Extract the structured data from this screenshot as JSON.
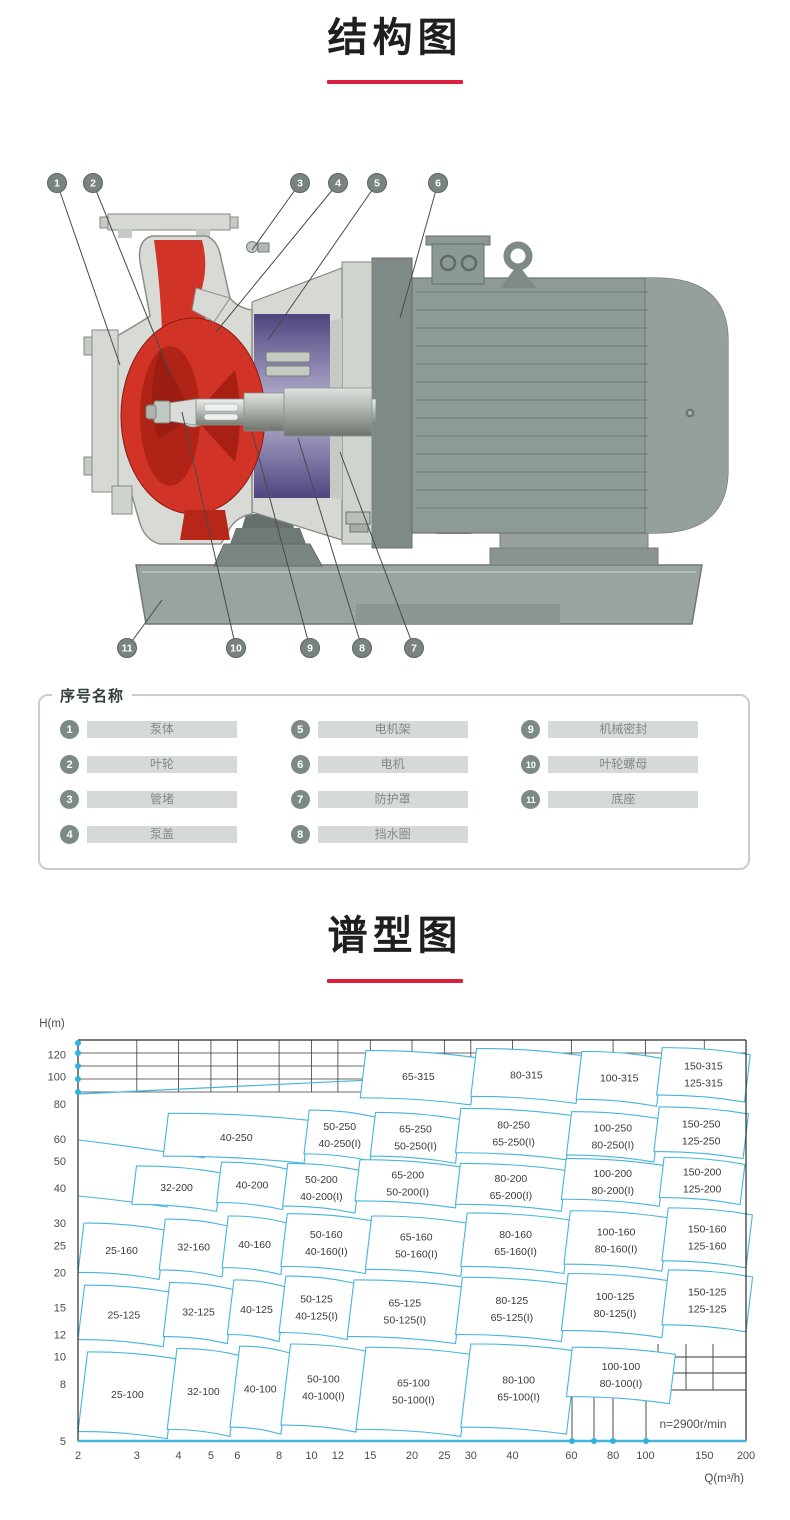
{
  "titles": {
    "structure": "结构图",
    "chart": "谱型图"
  },
  "structure": {
    "callouts": [
      "1",
      "2",
      "3",
      "4",
      "5",
      "6",
      "7",
      "8",
      "9",
      "10",
      "11"
    ]
  },
  "legend": {
    "title": "序号名称",
    "items": [
      {
        "num": "1",
        "name": "泵体"
      },
      {
        "num": "2",
        "name": "叶轮"
      },
      {
        "num": "3",
        "name": "管堵"
      },
      {
        "num": "4",
        "name": "泵盖"
      },
      {
        "num": "5",
        "name": "电机架"
      },
      {
        "num": "6",
        "name": "电机"
      },
      {
        "num": "7",
        "name": "防护罩"
      },
      {
        "num": "8",
        "name": "挡水圈"
      },
      {
        "num": "9",
        "name": "机械密封"
      },
      {
        "num": "10",
        "name": "叶轮螺母"
      },
      {
        "num": "11",
        "name": "底座"
      }
    ]
  },
  "chart_data": {
    "type": "region_map",
    "title": "谱型图",
    "xlabel": "Q(m³/h)",
    "ylabel": "H(m)",
    "x_scale": "log",
    "y_scale": "log",
    "xlim": [
      2,
      200
    ],
    "ylim": [
      5,
      137
    ],
    "x_ticks": [
      2,
      3,
      4,
      5,
      6,
      8,
      10,
      12,
      15,
      20,
      25,
      30,
      40,
      60,
      80,
      100,
      150,
      200
    ],
    "y_ticks": [
      5,
      8,
      10,
      12,
      15,
      20,
      25,
      30,
      40,
      50,
      60,
      80,
      100,
      120
    ],
    "annotation": "n=2900r/min",
    "line_color": "#45b5dc",
    "regions": [
      {
        "labels": [
          "65-315"
        ],
        "q": [
          14,
          30
        ],
        "h": [
          84,
          124
        ]
      },
      {
        "labels": [
          "80-315"
        ],
        "q": [
          30,
          62
        ],
        "h": [
          85,
          126
        ]
      },
      {
        "labels": [
          "100-315"
        ],
        "q": [
          62,
          108
        ],
        "h": [
          83,
          123
        ]
      },
      {
        "labels": [
          "150-315",
          "125-315"
        ],
        "q": [
          108,
          198
        ],
        "h": [
          86,
          127
        ]
      },
      {
        "labels": [
          "40-250"
        ],
        "q": [
          3.6,
          9.5
        ],
        "h": [
          52,
          74
        ]
      },
      {
        "labels": [
          "50-250",
          "40-250(I)"
        ],
        "q": [
          9.5,
          15
        ],
        "h": [
          53,
          76
        ]
      },
      {
        "labels": [
          "65-250",
          "50-250(I)"
        ],
        "q": [
          15,
          27
        ],
        "h": [
          52,
          74.5
        ]
      },
      {
        "labels": [
          "80-250",
          "65-250(I)"
        ],
        "q": [
          27,
          58
        ],
        "h": [
          53.5,
          77
        ]
      },
      {
        "labels": [
          "100-250",
          "80-250(I)"
        ],
        "q": [
          58,
          106
        ],
        "h": [
          52.5,
          75
        ]
      },
      {
        "labels": [
          "150-250",
          "125-250"
        ],
        "q": [
          106,
          196
        ],
        "h": [
          54,
          78
        ]
      },
      {
        "labels": [
          "32-200"
        ],
        "q": [
          2.9,
          5.2
        ],
        "h": [
          35,
          48
        ]
      },
      {
        "labels": [
          "40-200"
        ],
        "q": [
          5.2,
          8.2
        ],
        "h": [
          35.5,
          49.5
        ]
      },
      {
        "labels": [
          "50-200",
          "40-200(I)"
        ],
        "q": [
          8.2,
          13.5
        ],
        "h": [
          34.5,
          49
        ]
      },
      {
        "labels": [
          "65-200",
          "50-200(I)"
        ],
        "q": [
          13.5,
          27
        ],
        "h": [
          36,
          50.5
        ]
      },
      {
        "labels": [
          "80-200",
          "65-200(I)"
        ],
        "q": [
          27,
          56
        ],
        "h": [
          35,
          49
        ]
      },
      {
        "labels": [
          "100-200",
          "80-200(I)"
        ],
        "q": [
          56,
          110
        ],
        "h": [
          36.5,
          51
        ]
      },
      {
        "labels": [
          "150-200",
          "125-200"
        ],
        "q": [
          110,
          192
        ],
        "h": [
          37,
          51.5
        ]
      },
      {
        "labels": [
          "25-160"
        ],
        "q": [
          2,
          3.5
        ],
        "h": [
          20,
          30
        ]
      },
      {
        "labels": [
          "32-160"
        ],
        "q": [
          3.5,
          5.4
        ],
        "h": [
          20.4,
          31
        ]
      },
      {
        "labels": [
          "40-160"
        ],
        "q": [
          5.4,
          8.1
        ],
        "h": [
          20.8,
          31.8
        ]
      },
      {
        "labels": [
          "50-160",
          "40-160(I)"
        ],
        "q": [
          8.1,
          14.5
        ],
        "h": [
          21,
          32.4
        ]
      },
      {
        "labels": [
          "65-160",
          "50-160(I)"
        ],
        "q": [
          14.5,
          28
        ],
        "h": [
          20.5,
          31.8
        ]
      },
      {
        "labels": [
          "80-160",
          "65-160(I)"
        ],
        "q": [
          28,
          57
        ],
        "h": [
          21,
          32.6
        ]
      },
      {
        "labels": [
          "100-160",
          "80-160(I)"
        ],
        "q": [
          57,
          112
        ],
        "h": [
          21.4,
          33.2
        ]
      },
      {
        "labels": [
          "150-160",
          "125-160"
        ],
        "q": [
          112,
          200
        ],
        "h": [
          22,
          34
        ]
      },
      {
        "labels": [
          "25-125"
        ],
        "q": [
          2,
          3.6
        ],
        "h": [
          11.5,
          18
        ]
      },
      {
        "labels": [
          "32-125"
        ],
        "q": [
          3.6,
          5.6
        ],
        "h": [
          11.8,
          18.4
        ]
      },
      {
        "labels": [
          "40-125"
        ],
        "q": [
          5.6,
          8
        ],
        "h": [
          12,
          18.8
        ]
      },
      {
        "labels": [
          "50-125",
          "40-125(I)"
        ],
        "q": [
          8,
          12.8
        ],
        "h": [
          12.2,
          19.4
        ]
      },
      {
        "labels": [
          "65-125",
          "50-125(I)"
        ],
        "q": [
          12.8,
          27
        ],
        "h": [
          11.8,
          18.8
        ]
      },
      {
        "labels": [
          "80-125",
          "65-125(I)"
        ],
        "q": [
          27,
          56
        ],
        "h": [
          12,
          19.2
        ]
      },
      {
        "labels": [
          "100-125",
          "80-125(I)"
        ],
        "q": [
          56,
          112
        ],
        "h": [
          12.4,
          19.8
        ]
      },
      {
        "labels": [
          "150-125",
          "125-125"
        ],
        "q": [
          112,
          200
        ],
        "h": [
          13,
          20.4
        ]
      },
      {
        "labels": [
          "25-100"
        ],
        "q": [
          2,
          3.7
        ],
        "h": [
          5.4,
          10.4
        ]
      },
      {
        "labels": [
          "32-100"
        ],
        "q": [
          3.7,
          5.7
        ],
        "h": [
          5.5,
          10.7
        ]
      },
      {
        "labels": [
          "40-100"
        ],
        "q": [
          5.7,
          8.1
        ],
        "h": [
          5.6,
          10.9
        ]
      },
      {
        "labels": [
          "50-100",
          "40-100(I)"
        ],
        "q": [
          8.1,
          13.6
        ],
        "h": [
          5.7,
          11.1
        ]
      },
      {
        "labels": [
          "65-100",
          "50-100(I)"
        ],
        "q": [
          13.6,
          28
        ],
        "h": [
          5.5,
          10.8
        ]
      },
      {
        "labels": [
          "80-100",
          "65-100(I)"
        ],
        "q": [
          28,
          58
        ],
        "h": [
          5.6,
          11.1
        ]
      },
      {
        "labels": [
          "100-100",
          "80-100(I)"
        ],
        "q": [
          58,
          118
        ],
        "h": [
          7.2,
          10.8
        ]
      }
    ]
  },
  "colors": {
    "accent_red": "#db1f3d",
    "chart_line": "#45b5dc",
    "pump_red": "#d13326",
    "bracket_purple": "#5a5088",
    "motor_gray": "#8e9a95",
    "legend_circle": "#7c8a86"
  }
}
